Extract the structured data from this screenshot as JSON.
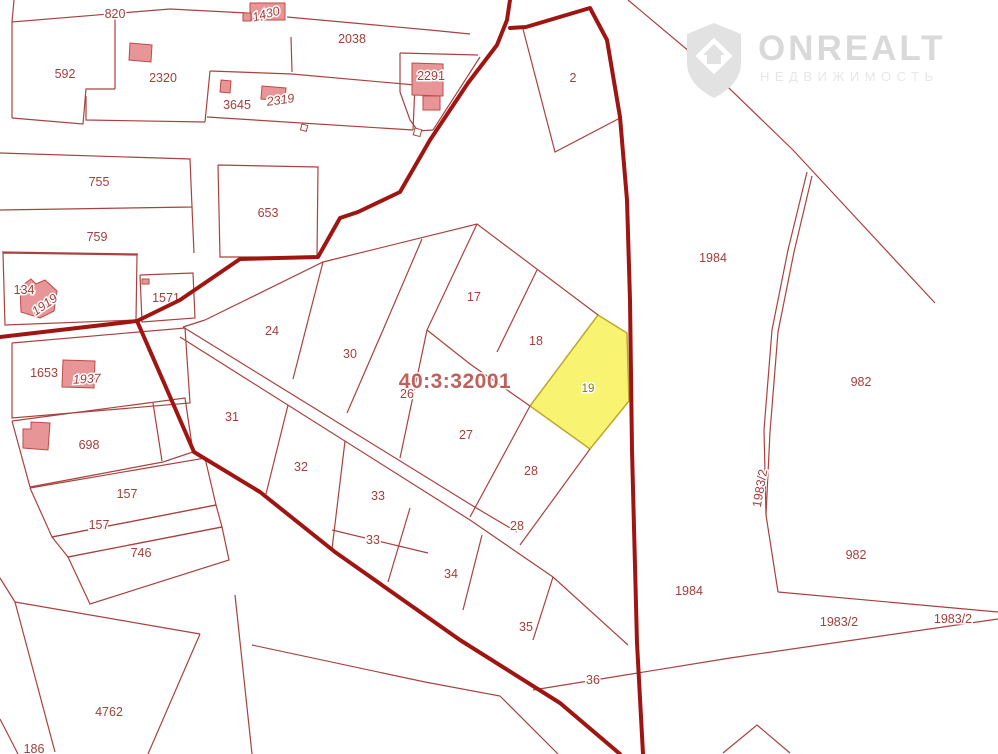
{
  "watermark": {
    "brand": "ONREALT",
    "subtitle": "НЕДВИЖИМОСТЬ",
    "brand_color": "#d9d9d9",
    "subtitle_color": "#e7e7e7",
    "shield_color": "#e2e2e2"
  },
  "map": {
    "quarter_label": {
      "text": "40:3:32001",
      "x": 455,
      "y": 388,
      "color": "#b5504b"
    },
    "highlight_parcel": {
      "number": "19",
      "points": "598,315 627,333 629,401 590,449 530,406",
      "fill": "#f8f472",
      "stroke": "#bfa62c",
      "label": {
        "t": "19",
        "x": 588,
        "y": 392,
        "color": "#8d7b00"
      }
    },
    "colors": {
      "thin_line": "#a8423f",
      "thick_line": "#9e1512",
      "label": "#a23f3b",
      "building_fill": "#e89597",
      "building_stroke": "#bf4a46"
    },
    "thin_lines": [
      {
        "pts": "14,0 12,22 170,9 247,13"
      },
      {
        "pts": "287,17 430,30 470,34"
      },
      {
        "pts": "12,22 12,118"
      },
      {
        "pts": "12,118 83,124 86,89 115,89"
      },
      {
        "pts": "115,17 115,89"
      },
      {
        "pts": "86,96 86,120 205,122"
      },
      {
        "pts": "210,71 292,74 415,85"
      },
      {
        "pts": "207,117 413,130"
      },
      {
        "pts": "205,122 210,71"
      },
      {
        "pts": "415,85 413,130"
      },
      {
        "pts": "291,37 292,72"
      },
      {
        "pts": "400,53 478,55"
      },
      {
        "pts": "400,53 400,92"
      },
      {
        "pts": "400,92 410,120 418,131 433,130"
      },
      {
        "pts": "480,57 433,130"
      },
      {
        "pts": "218,165 318,167 317,257 220,257 218,165"
      },
      {
        "pts": "0,153 190,159 192,207 0,210"
      },
      {
        "pts": "2,252 138,254"
      },
      {
        "pts": "192,207 194,253"
      },
      {
        "pts": "140,275 193,273 195,318 142,322 140,275"
      },
      {
        "pts": "3,253 137,255 136,320 5,325 3,253"
      },
      {
        "pts": "12,343 185,328 190,403 12,418 12,343"
      },
      {
        "pts": "12,421 185,398 193,452 163,462 30,487 12,421"
      },
      {
        "pts": "153,403 162,461"
      },
      {
        "pts": "30,488 205,458 216,505 52,537 30,488"
      },
      {
        "pts": "52,537 216,505 222,527 68,557 52,537"
      },
      {
        "pts": "68,557 222,527 229,560 90,604 68,557"
      },
      {
        "pts": "15,602 0,578"
      },
      {
        "pts": "15,602 55,752"
      },
      {
        "pts": "15,602 200,634"
      },
      {
        "pts": "200,634 148,754"
      },
      {
        "pts": "0,719 18,754"
      },
      {
        "pts": "235,595 252,754"
      },
      {
        "pts": "252,645 425,682 500,696 558,754"
      },
      {
        "pts": "523,29 555,152 620,118"
      },
      {
        "pts": "628,0 703,63 793,150 935,303"
      },
      {
        "pts": "807,172 788,250 772,330 764,430 766,515"
      },
      {
        "pts": "812,176 794,252 778,332 770,432 766,515"
      },
      {
        "pts": "766,515 778,592"
      },
      {
        "pts": "778,592 998,612"
      },
      {
        "pts": "533,690 730,658 998,619"
      },
      {
        "pts": "723,753 757,725 790,753"
      },
      {
        "pts": "205,320 323,262 477,224 598,315"
      },
      {
        "pts": "477,224 427,330"
      },
      {
        "pts": "427,330 470,364 530,406"
      },
      {
        "pts": "537,270 497,352"
      },
      {
        "pts": "323,262 293,379"
      },
      {
        "pts": "422,239 383,330 347,413"
      },
      {
        "pts": "427,330 400,458"
      },
      {
        "pts": "530,406 470,517"
      },
      {
        "pts": "183,327 473,506 517,532"
      },
      {
        "pts": "180,337 470,520 553,577"
      },
      {
        "pts": "205,320 183,327"
      },
      {
        "pts": "288,405 266,494"
      },
      {
        "pts": "345,441 332,549"
      },
      {
        "pts": "332,530 428,553"
      },
      {
        "pts": "410,508 388,582"
      },
      {
        "pts": "482,535 463,610"
      },
      {
        "pts": "553,577 533,640"
      },
      {
        "pts": "553,577 628,645"
      },
      {
        "pts": "590,449 520,545"
      }
    ],
    "thick_lines": [
      {
        "pts": "510,0 507,20 497,45 468,83 430,140 400,192 358,212 340,218 318,257 240,259 180,300 137,321"
      },
      {
        "pts": "137,321 0,337"
      },
      {
        "pts": "137,321 168,392 194,452 260,492 335,552 460,640 560,703 620,754"
      },
      {
        "pts": "510,28 526,27 590,8 607,40 620,117 627,200 630,300 632,450 637,643 643,754"
      }
    ],
    "buildings": [
      {
        "pts": "250,3 285,3 285,20 250,20"
      },
      {
        "pts": "243,13 251,13 251,21 243,21"
      },
      {
        "pts": "130,43 152,45 151,62 129,60"
      },
      {
        "pts": "221,80 231,81 230,93 220,92"
      },
      {
        "pts": "262,86 286,88 285,101 261,99"
      },
      {
        "pts": "412,63 443,64 443,96 412,95"
      },
      {
        "pts": "423,96 440,96 440,110 423,110"
      },
      {
        "pts": "20,287 31,279 36,284 45,280 57,291 54,311 40,318 21,312"
      },
      {
        "pts": "63,360 95,361 94,388 62,387"
      },
      {
        "pts": "23,429 31,429 31,422 50,423 48,450 23,448"
      },
      {
        "pts": "142,279 149,279 149,284 142,284"
      }
    ],
    "markers": [
      {
        "x": 302,
        "y": 124,
        "s": 6
      },
      {
        "x": 415,
        "y": 128,
        "s": 7
      }
    ],
    "labels": [
      {
        "t": "820",
        "x": 115,
        "y": 18
      },
      {
        "t": "1430",
        "x": 267,
        "y": 18,
        "r": -15,
        "c": "italic"
      },
      {
        "t": "2038",
        "x": 352,
        "y": 43
      },
      {
        "t": "592",
        "x": 65,
        "y": 78
      },
      {
        "t": "2320",
        "x": 163,
        "y": 82
      },
      {
        "t": "3645",
        "x": 237,
        "y": 109
      },
      {
        "t": "2319",
        "x": 281,
        "y": 104,
        "r": -8,
        "c": "italic"
      },
      {
        "t": "2291",
        "x": 431,
        "y": 80
      },
      {
        "t": "2",
        "x": 573,
        "y": 82
      },
      {
        "t": "755",
        "x": 99,
        "y": 186
      },
      {
        "t": "653",
        "x": 268,
        "y": 217
      },
      {
        "t": "759",
        "x": 97,
        "y": 241
      },
      {
        "t": "134",
        "x": 24,
        "y": 294
      },
      {
        "t": "1919",
        "x": 47,
        "y": 308,
        "r": -35,
        "c": "italic"
      },
      {
        "t": "1571",
        "x": 166,
        "y": 302
      },
      {
        "t": "24",
        "x": 272,
        "y": 335
      },
      {
        "t": "1653",
        "x": 44,
        "y": 377
      },
      {
        "t": "1937",
        "x": 87,
        "y": 383,
        "r": -3,
        "c": "italic"
      },
      {
        "t": "30",
        "x": 350,
        "y": 358
      },
      {
        "t": "17",
        "x": 474,
        "y": 301
      },
      {
        "t": "18",
        "x": 536,
        "y": 345
      },
      {
        "t": "26",
        "x": 407,
        "y": 398
      },
      {
        "t": "698",
        "x": 89,
        "y": 449
      },
      {
        "t": "31",
        "x": 232,
        "y": 421
      },
      {
        "t": "27",
        "x": 466,
        "y": 439
      },
      {
        "t": "32",
        "x": 301,
        "y": 471
      },
      {
        "t": "157",
        "x": 127,
        "y": 498
      },
      {
        "t": "33",
        "x": 378,
        "y": 500
      },
      {
        "t": "157",
        "x": 99,
        "y": 529
      },
      {
        "t": "28",
        "x": 531,
        "y": 475
      },
      {
        "t": "28",
        "x": 517,
        "y": 530
      },
      {
        "t": "33",
        "x": 373,
        "y": 544
      },
      {
        "t": "746",
        "x": 141,
        "y": 557
      },
      {
        "t": "34",
        "x": 451,
        "y": 578
      },
      {
        "t": "35",
        "x": 526,
        "y": 631
      },
      {
        "t": "36",
        "x": 593,
        "y": 684
      },
      {
        "t": "4762",
        "x": 109,
        "y": 716
      },
      {
        "t": "186",
        "x": 34,
        "y": 753
      },
      {
        "t": "1984",
        "x": 713,
        "y": 262
      },
      {
        "t": "982",
        "x": 861,
        "y": 386
      },
      {
        "t": "1983/2",
        "x": 764,
        "y": 489,
        "r": -80
      },
      {
        "t": "982",
        "x": 856,
        "y": 559
      },
      {
        "t": "1984",
        "x": 689,
        "y": 595
      },
      {
        "t": "1983/2",
        "x": 839,
        "y": 626
      },
      {
        "t": "1983/2",
        "x": 953,
        "y": 623
      }
    ]
  }
}
